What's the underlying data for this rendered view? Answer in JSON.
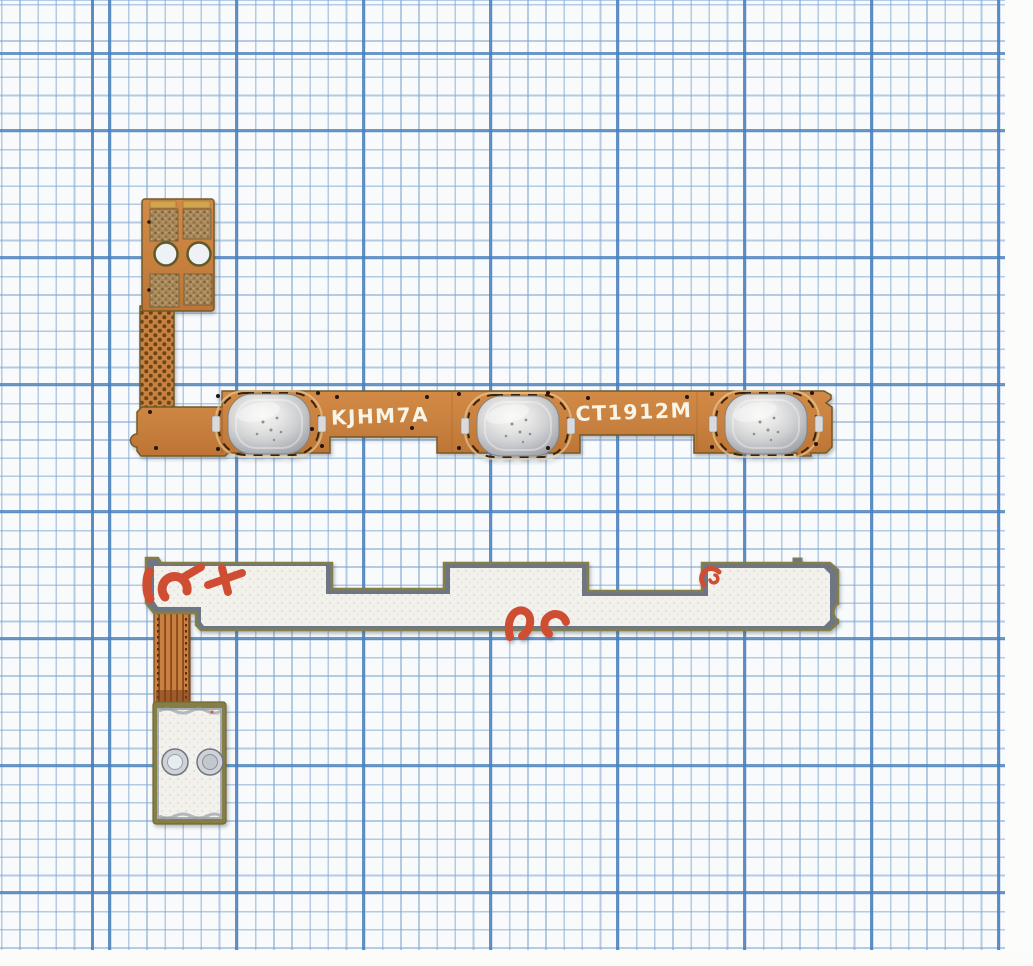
{
  "photo": {
    "subject": "Two smartphone power/volume button flex cables (front and back views) lying on blue graph paper",
    "paper": {
      "background": "#f8fafc",
      "minor_line_color": "#7ca4d1",
      "major_line_color": "#487fbc"
    }
  },
  "top_cable": {
    "view": "front side - orange flex PCB with three metal dome switches and connector tail",
    "marking_left": "KJHM7A",
    "marking_right": "CT1912M",
    "button_count": 3,
    "connector_hole_count": 2,
    "colors": {
      "flex_orange": "#c8813f",
      "edge_olive": "#6f5a2a",
      "dome_silver": "#c9cacd",
      "contact_bronze": "#a8895b",
      "silkscreen_white": "#f7f4e8",
      "dashed_marks": "#3a2008"
    }
  },
  "bottom_cable": {
    "view": "back side - steel stiffener with white adhesive liner, red print fragments (illegible), flex tail with screw pad",
    "liner_print": "red print fragments (partial, illegible)",
    "pad_hole_count": 2,
    "colors": {
      "liner_white": "#f3f1ec",
      "stiffener_gray": "#6e7684",
      "rim_khaki": "#857f47",
      "print_red": "#cf4e33",
      "ribbon_orange": "#c8813f"
    }
  }
}
